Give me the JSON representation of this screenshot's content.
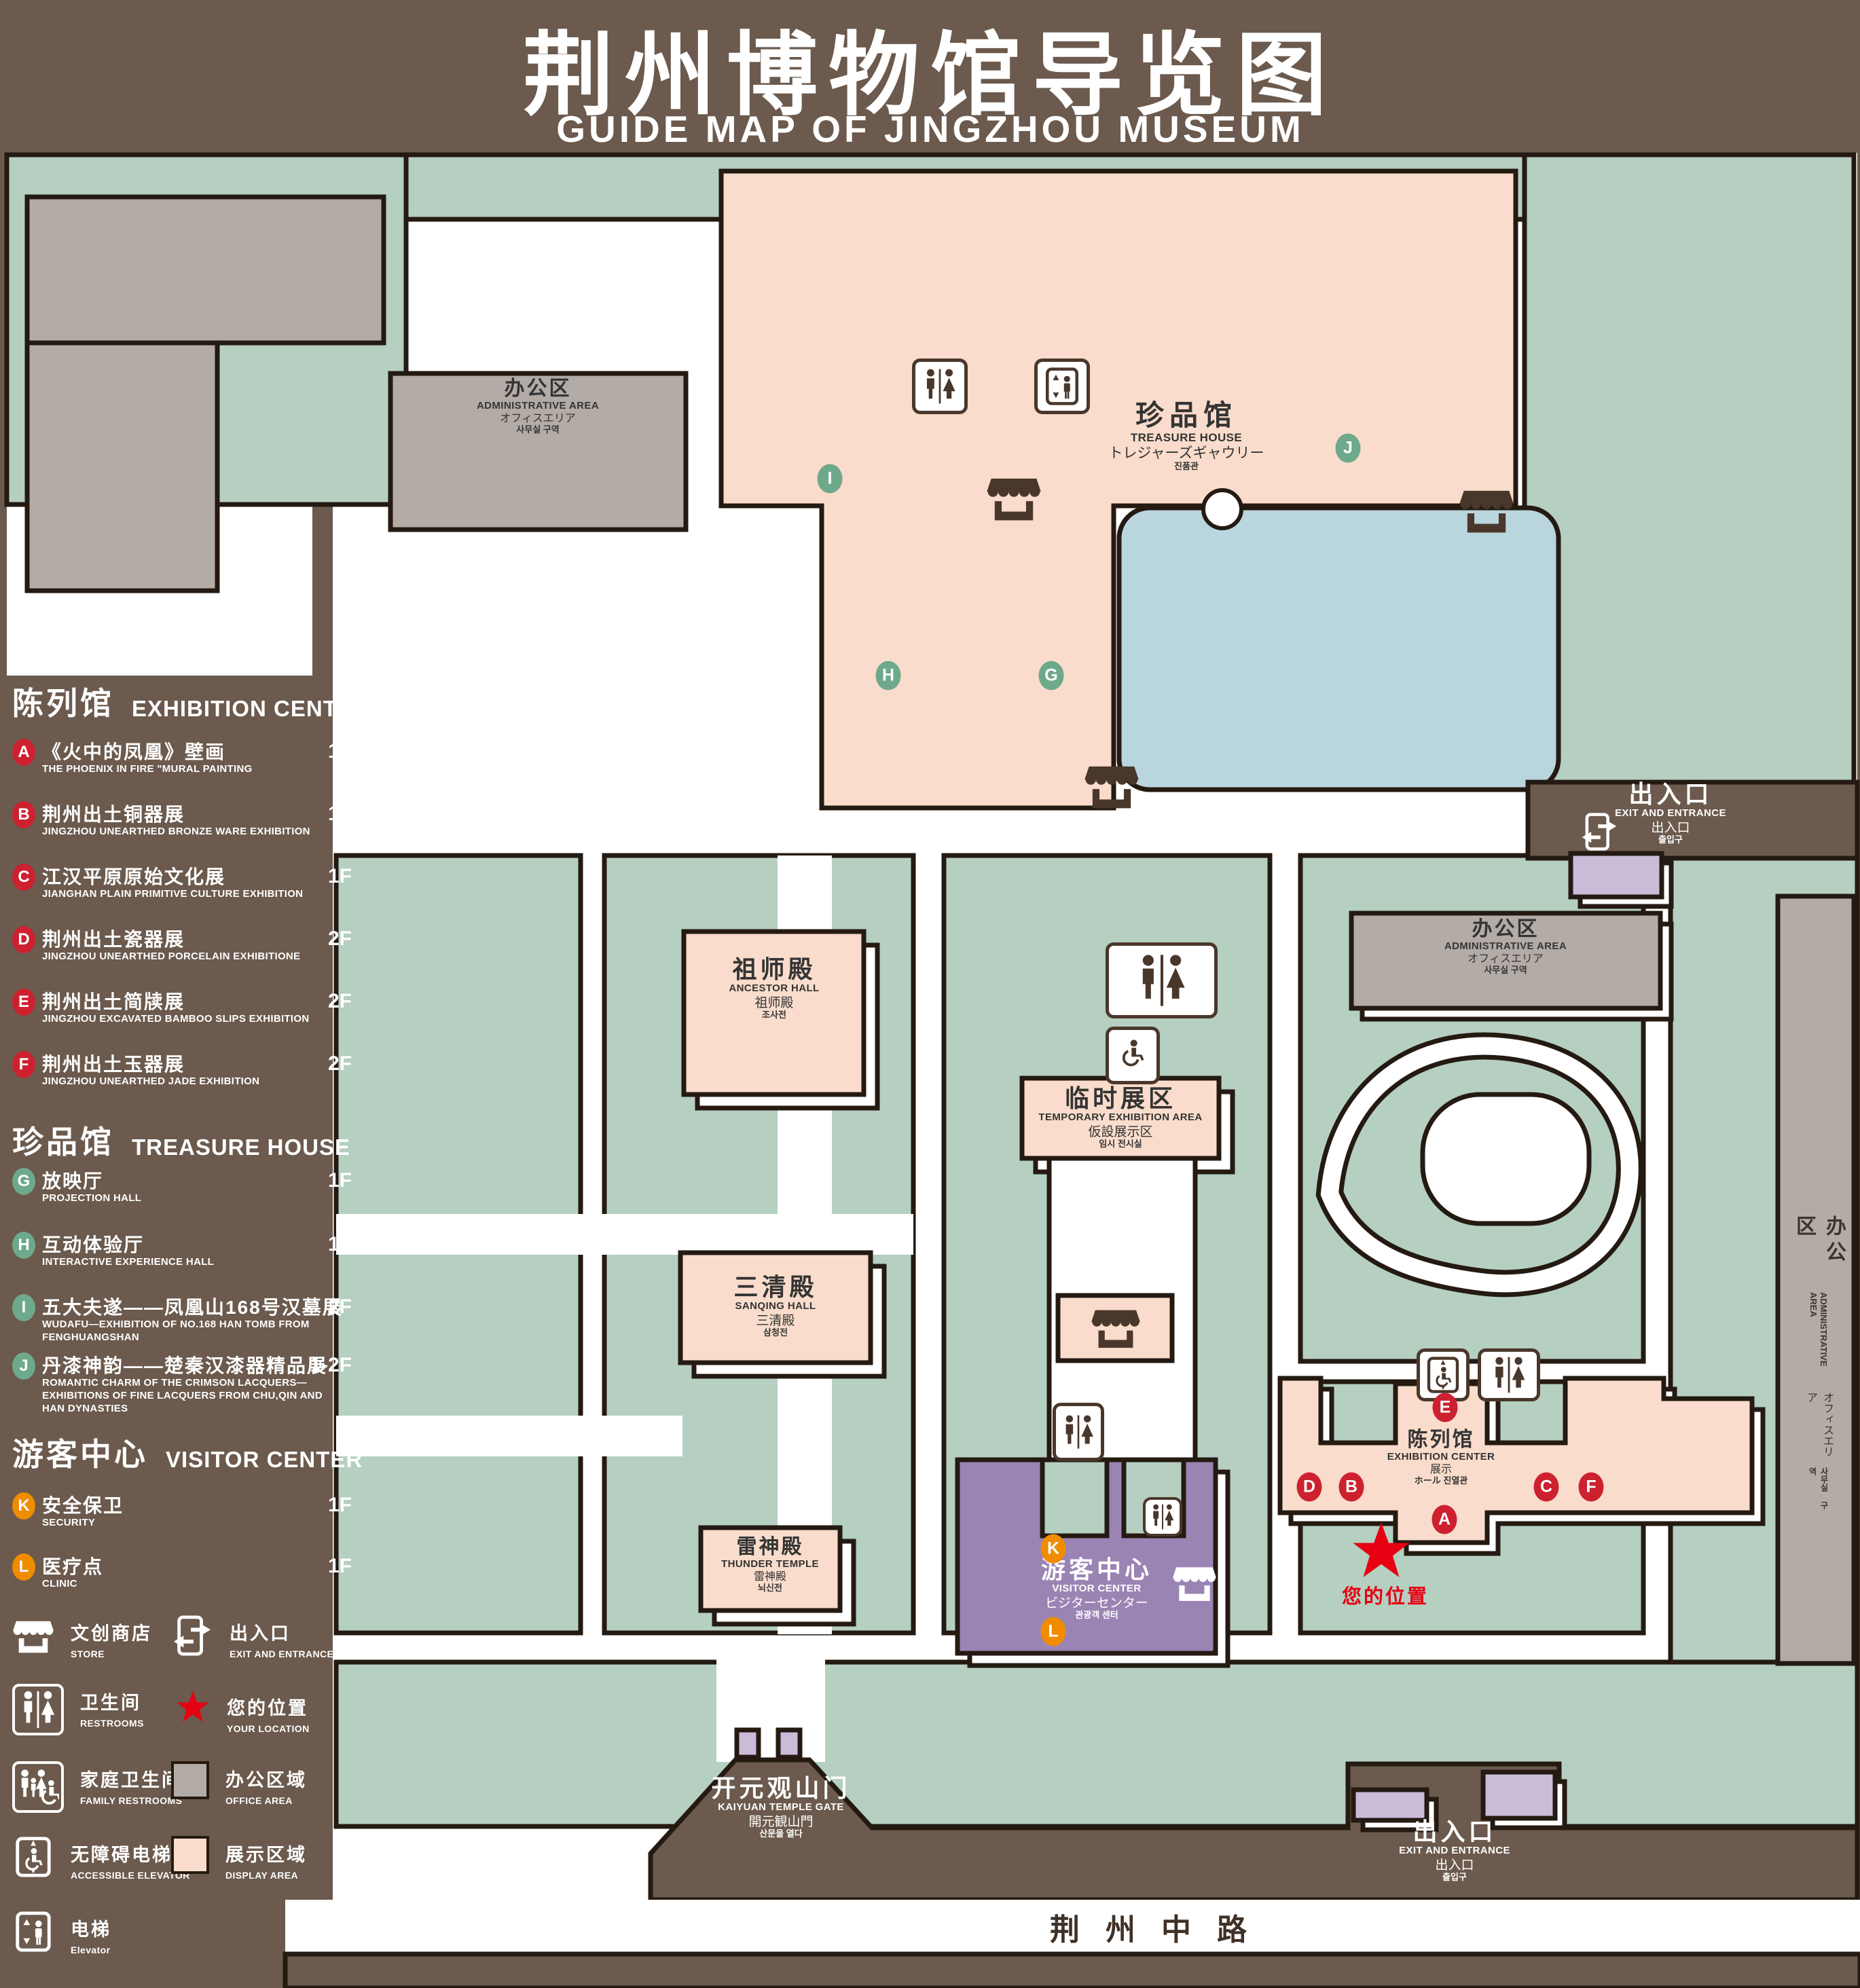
{
  "title": {
    "cn": "荆州博物馆导览图",
    "en": "GUIDE MAP OF JINGZHOU MUSEUM"
  },
  "colors": {
    "background": "#6b5a4d",
    "green_space": "#b5cfc1",
    "display_area": "#f9dccb",
    "office_area": "#b3aba6",
    "water": "#b9d5de",
    "visitor_center_building": "#9a84b4",
    "minor_building": "#cabbd9",
    "marker_red": "#cd2130",
    "marker_green": "#6fa98c",
    "marker_orange": "#f08c00",
    "location_red": "#e60012"
  },
  "legend": {
    "sections": [
      {
        "title_cn": "陈列馆",
        "title_en": "EXHIBITION CENTER",
        "items": [
          {
            "letter": "A",
            "cn": "《火中的凤凰》壁画",
            "en": "THE PHOENIX IN FIRE \"MURAL PAINTING",
            "floor": "1F"
          },
          {
            "letter": "B",
            "cn": "荆州出土铜器展",
            "en": "JINGZHOU UNEARTHED BRONZE WARE EXHIBITION",
            "floor": "1F"
          },
          {
            "letter": "C",
            "cn": "江汉平原原始文化展",
            "en": "JIANGHAN PLAIN PRIMITIVE CULTURE EXHIBITION",
            "floor": "1F"
          },
          {
            "letter": "D",
            "cn": "荆州出土瓷器展",
            "en": "JINGZHOU UNEARTHED PORCELAIN EXHIBITIONE",
            "floor": "2F"
          },
          {
            "letter": "E",
            "cn": "荆州出土简牍展",
            "en": "JINGZHOU EXCAVATED BAMBOO SLIPS EXHIBITION",
            "floor": "2F"
          },
          {
            "letter": "F",
            "cn": "荆州出土玉器展",
            "en": "JINGZHOU UNEARTHED JADE EXHIBITION",
            "floor": "2F"
          }
        ]
      },
      {
        "title_cn": "珍品馆",
        "title_en": "TREASURE HOUSE",
        "items": [
          {
            "letter": "G",
            "cn": "放映厅",
            "en": "PROJECTION HALL",
            "floor": "1F"
          },
          {
            "letter": "H",
            "cn": "互动体验厅",
            "en": "INTERACTIVE EXPERIENCE HALL",
            "floor": "1F"
          },
          {
            "letter": "I",
            "cn": "五大夫遂——凤凰山168号汉墓展",
            "en": "WUDAFU—EXHIBITION OF NO.168 HAN TOMB FROM FENGHUANGSHAN",
            "floor": "2F"
          },
          {
            "letter": "J",
            "cn": "丹漆神韵——楚秦汉漆器精品展",
            "en": "ROMANTIC CHARM OF THE CRIMSON LACQUERS—EXHIBITIONS OF FINE LACQUERS FROM CHU,QIN AND HAN DYNASTIES",
            "floor": "1-2F"
          }
        ]
      },
      {
        "title_cn": "游客中心",
        "title_en": "VISITOR CENTER",
        "items": [
          {
            "letter": "K",
            "cn": "安全保卫",
            "en": "SECURITY",
            "floor": "1F"
          },
          {
            "letter": "L",
            "cn": "医疗点",
            "en": "CLINIC",
            "floor": "1F"
          }
        ]
      }
    ],
    "symbols": {
      "store": {
        "cn": "文创商店",
        "en": "STORE"
      },
      "exit": {
        "cn": "出入口",
        "en": "EXIT AND ENTRANCE"
      },
      "restrooms": {
        "cn": "卫生间",
        "en": "RESTROOMS"
      },
      "your_location": {
        "cn": "您的位置",
        "en": "YOUR LOCATION"
      },
      "family_restrooms": {
        "cn": "家庭卫生间",
        "en": "FAMILY RESTROOMS"
      },
      "office_area": {
        "cn": "办公区域",
        "en": "OFFICE AREA"
      },
      "accessible_elevator": {
        "cn": "无障碍电梯",
        "en": "ACCESSIBLE ELEVATOR"
      },
      "display_area": {
        "cn": "展示区域",
        "en": "DISPLAY AREA"
      },
      "elevator": {
        "cn": "电梯",
        "en": "Elevator"
      }
    }
  },
  "map": {
    "labels": {
      "admin": {
        "cn": "办公区",
        "en": "ADMINISTRATIVE AREA",
        "jp": "オフィスエリア",
        "kr": "사무실 구역"
      },
      "treasure_house": {
        "cn": "珍品馆",
        "en": "TREASURE HOUSE",
        "jp": "トレジャーズギャウリー",
        "kr": "진품관"
      },
      "ancestor_hall": {
        "cn": "祖师殿",
        "en": "ANCESTOR HALL",
        "jp": "祖师殿",
        "kr": "조사전"
      },
      "temporary_exhibition": {
        "cn": "临时展区",
        "en": "TEMPORARY EXHIBITION AREA",
        "jp": "仮設展示区",
        "kr": "임시 전시실"
      },
      "sanqing_hall": {
        "cn": "三清殿",
        "en": "SANQING HALL",
        "jp": "三清殿",
        "kr": "삼청전"
      },
      "thunder_temple": {
        "cn": "雷神殿",
        "en": "THUNDER TEMPLE",
        "jp": "雷神殿",
        "kr": "뇌신전"
      },
      "visitor_center": {
        "cn": "游客中心",
        "en": "VISITOR CENTER",
        "jp": "ビジターセンター",
        "kr": "관광객 센터"
      },
      "exhibition_center": {
        "cn": "陈列馆",
        "en": "EXHIBITION CENTER",
        "jp": "展示",
        "jp2": "ホール",
        "kr": "진열관"
      },
      "exit": {
        "cn": "出入口",
        "en": "EXIT AND ENTRANCE",
        "jp": "出入口",
        "kr": "출입구"
      },
      "gate": {
        "cn": "开元观山门",
        "en": "KAIYUAN TEMPLE GATE",
        "jp": "開元観山門",
        "kr": "산문을 열다"
      },
      "your_location": "您的位置",
      "road": "荆州中路"
    },
    "markers": {
      "red": [
        "A",
        "B",
        "C",
        "D",
        "E",
        "F"
      ],
      "green": [
        "G",
        "H",
        "I",
        "J"
      ],
      "orange": [
        "K",
        "L"
      ]
    }
  }
}
